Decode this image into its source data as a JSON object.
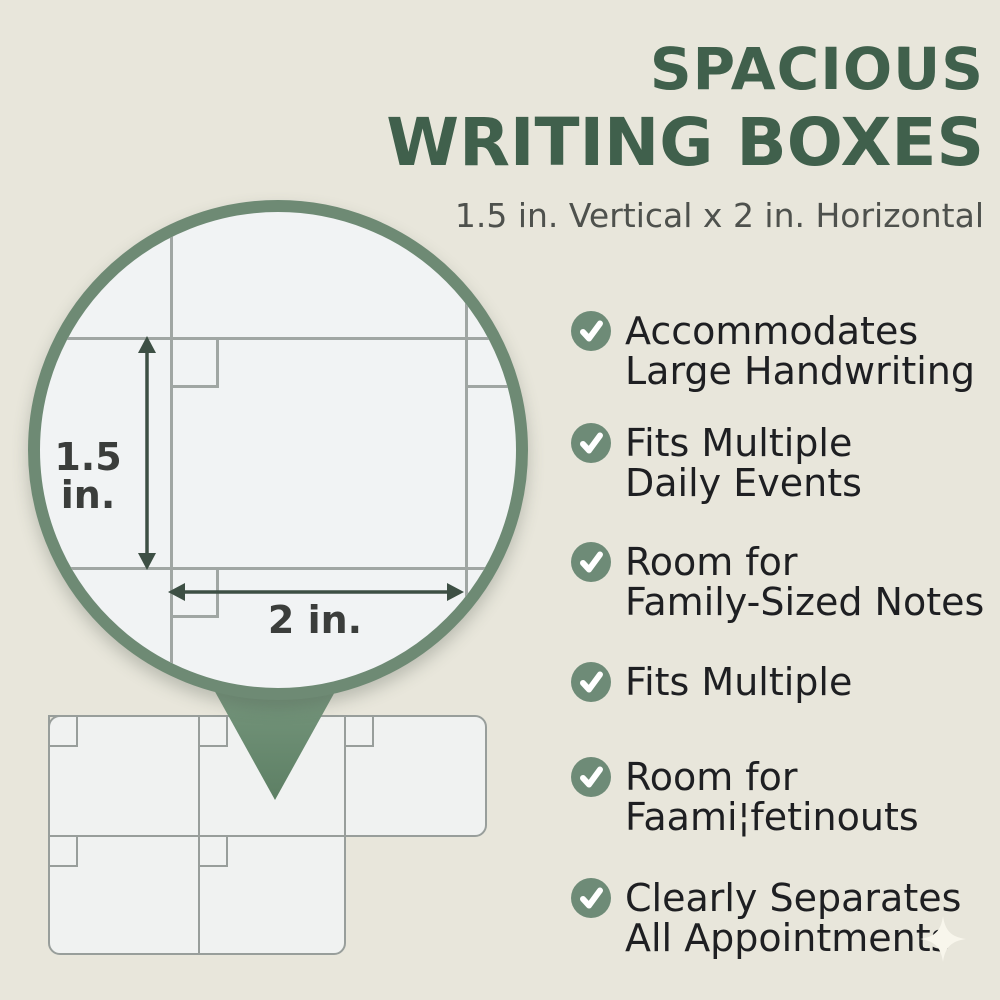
{
  "header": {
    "title_line1": "SPACIOUS",
    "title_line2": "WRITING BOXES",
    "subtitle": "1.5 in. Vertical x 2 in. Horizontal"
  },
  "magnifier": {
    "vertical_dimension_label": "1.5 in.",
    "horizontal_dimension_label": "2 in."
  },
  "features": {
    "items": [
      {
        "lines": [
          "Accommodates",
          "Large Handwriting"
        ]
      },
      {
        "lines": [
          "Fits Multiple",
          "Daily Events"
        ]
      },
      {
        "lines": [
          "Room for",
          "Family-Sized Notes"
        ]
      },
      {
        "lines": [
          "Fits Multiple"
        ]
      },
      {
        "lines": [
          "Room for",
          "Faami¦fetinouts"
        ]
      },
      {
        "lines": [
          "Clearly Separates",
          "All Appointments"
        ]
      }
    ]
  },
  "colors": {
    "background": "#e8e6db",
    "title_green": "#40604c",
    "subtitle_gray": "#4e514d",
    "list_text_dark": "#1e1f22",
    "check_circle_green": "#6e8b77",
    "magnifier_ring_green": "#6e8a74",
    "grid_line_gray": "#a0a6a3",
    "dimension_arrow_green": "#3d4f44",
    "paper_white": "#f1f3f4",
    "sparkle_cream": "#f8f6ec"
  }
}
